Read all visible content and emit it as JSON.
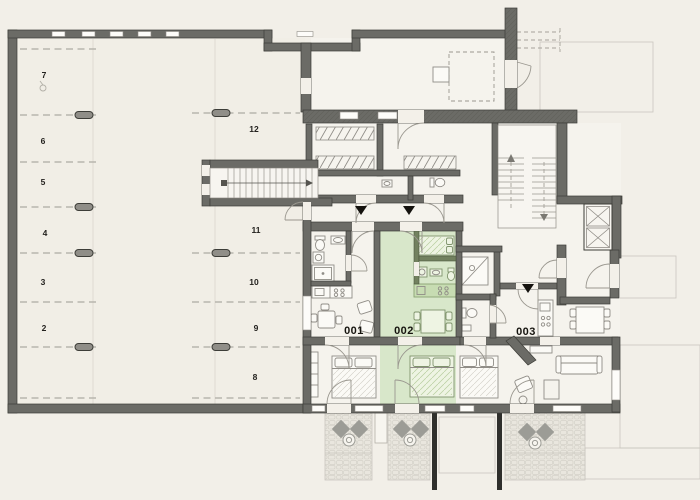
{
  "parking": {
    "left": [
      "7",
      "6",
      "5",
      "4",
      "3",
      "2"
    ],
    "right": [
      "12",
      "11",
      "10",
      "9",
      "8"
    ]
  },
  "units": [
    {
      "label": "001",
      "highlighted": false
    },
    {
      "label": "002",
      "highlighted": true
    },
    {
      "label": "003",
      "highlighted": false
    }
  ],
  "colors": {
    "background": "#f2efe8",
    "wall": "#6b6b66",
    "wall_edge": "#3d3d38",
    "unit_highlight": "#d8e7ca",
    "unit_highlight_tile": "#c7dcb2",
    "unit_highlight_texture": "#b7cd9f",
    "exterior_area": "#ebe9e1",
    "paving_stone": "#d2cfc6",
    "entrance_marker": "#14120e"
  }
}
